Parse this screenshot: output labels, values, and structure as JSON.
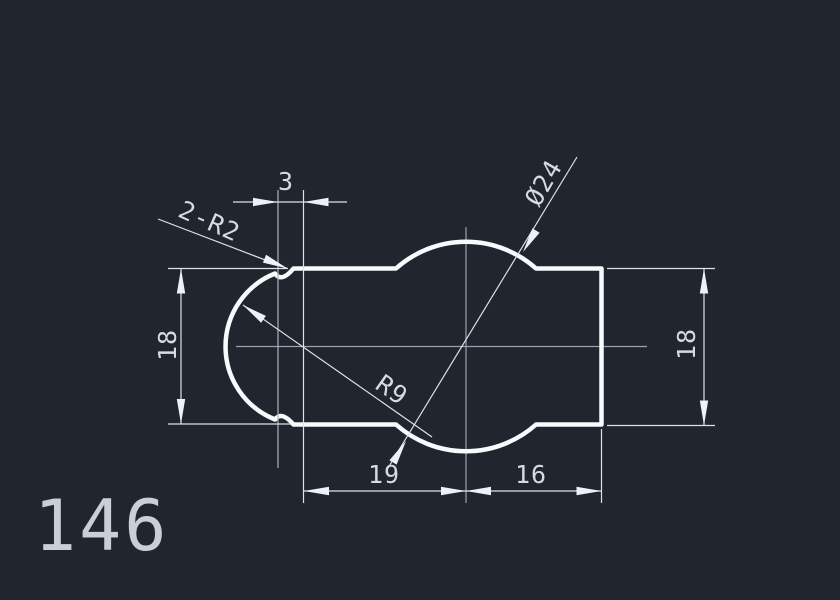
{
  "drawing_number": "146",
  "labels": {
    "top_width": "3",
    "fillet": "2-R2",
    "diameter": "Ø24",
    "radius": "R9",
    "left_height": "18",
    "right_height": "18",
    "bottom_left": "19",
    "bottom_right": "16"
  },
  "colors": {
    "background": "#20252e",
    "profile_line": "#f8fafc",
    "dimension_line": "#dde2e8",
    "centerline": "#9ba3ad",
    "arrow_fill": "#eef1f5",
    "dim_text": "#d6dbe2",
    "number_text": "#c9cfd7"
  }
}
